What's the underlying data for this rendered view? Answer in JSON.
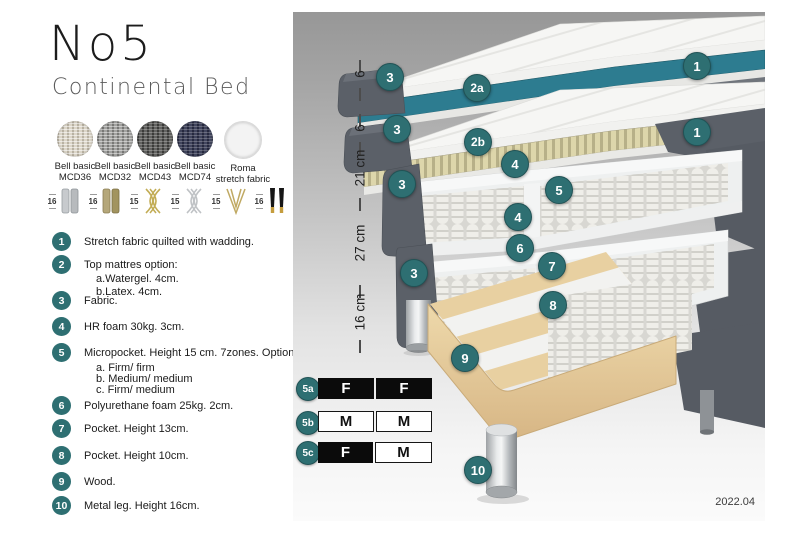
{
  "header": {
    "title": "No5",
    "subtitle": "Continental Bed"
  },
  "swatches": [
    {
      "line1": "Bell basic",
      "line2": "MCD36"
    },
    {
      "line1": "Bell basic",
      "line2": "MCD32"
    },
    {
      "line1": "Bell basic",
      "line2": "MCD43"
    },
    {
      "line1": "Bell basic",
      "line2": "MCD74"
    },
    {
      "line1": "Roma",
      "line2": "stretch fabric"
    }
  ],
  "legs": [
    {
      "height": "16",
      "type": "silver-cylinder-leg"
    },
    {
      "height": "16",
      "type": "brass-cylinder-leg"
    },
    {
      "height": "15",
      "type": "gold-cross-leg"
    },
    {
      "height": "15",
      "type": "silver-cross-leg"
    },
    {
      "height": "15",
      "type": "hairpin-leg"
    },
    {
      "height": "16",
      "type": "black-gold-leg"
    }
  ],
  "list": {
    "items": [
      {
        "num": "1",
        "text": "Stretch fabric quilted with wadding.",
        "sub": []
      },
      {
        "num": "2",
        "text": "Top mattres option:",
        "sub": [
          "a.Watergel. 4cm.",
          "b.Latex. 4cm."
        ]
      },
      {
        "num": "3",
        "text": "Fabric.",
        "sub": []
      },
      {
        "num": "4",
        "text": "HR foam 30kg. 3cm.",
        "sub": []
      },
      {
        "num": "5",
        "text": "Micropocket. Height 15 cm. 7zones. Option:",
        "sub": [
          "a. Firm/ firm",
          "b. Medium/ medium",
          "c. Firm/ medium"
        ]
      },
      {
        "num": "6",
        "text": "Polyurethane foam 25kg. 2cm.",
        "sub": []
      },
      {
        "num": "7",
        "text": "Pocket. Height 13cm.",
        "sub": []
      },
      {
        "num": "8",
        "text": "Pocket. Height 10cm.",
        "sub": []
      },
      {
        "num": "9",
        "text": "Wood.",
        "sub": []
      },
      {
        "num": "10",
        "text": "Metal leg. Height 16cm.",
        "sub": []
      }
    ]
  },
  "diagram": {
    "measurements": [
      "6",
      "6",
      "21 cm",
      "27 cm",
      "16 cm"
    ],
    "badges": [
      {
        "label": "1"
      },
      {
        "label": "3"
      },
      {
        "label": "2a"
      },
      {
        "label": "3"
      },
      {
        "label": "2b"
      },
      {
        "label": "1"
      },
      {
        "label": "4"
      },
      {
        "label": "5"
      },
      {
        "label": "3"
      },
      {
        "label": "4"
      },
      {
        "label": "6"
      },
      {
        "label": "7"
      },
      {
        "label": "3"
      },
      {
        "label": "8"
      },
      {
        "label": "9"
      },
      {
        "label": "10"
      }
    ],
    "firmness_table": {
      "rows": [
        {
          "label": "5a",
          "cells": [
            {
              "text": "F"
            },
            {
              "text": "F"
            }
          ]
        },
        {
          "label": "5b",
          "cells": [
            {
              "text": "M"
            },
            {
              "text": "M"
            }
          ]
        },
        {
          "label": "5c",
          "cells": [
            {
              "text": "F"
            },
            {
              "text": "M"
            }
          ]
        }
      ]
    },
    "version": "2022.04"
  },
  "colors": {
    "accent_teal": "#2e6f72",
    "watergel_teal": "#2d7c90",
    "latex_khaki": "#ddd6ab",
    "fabric_gray": "#5b6068",
    "wood": "#e8d0a1"
  }
}
